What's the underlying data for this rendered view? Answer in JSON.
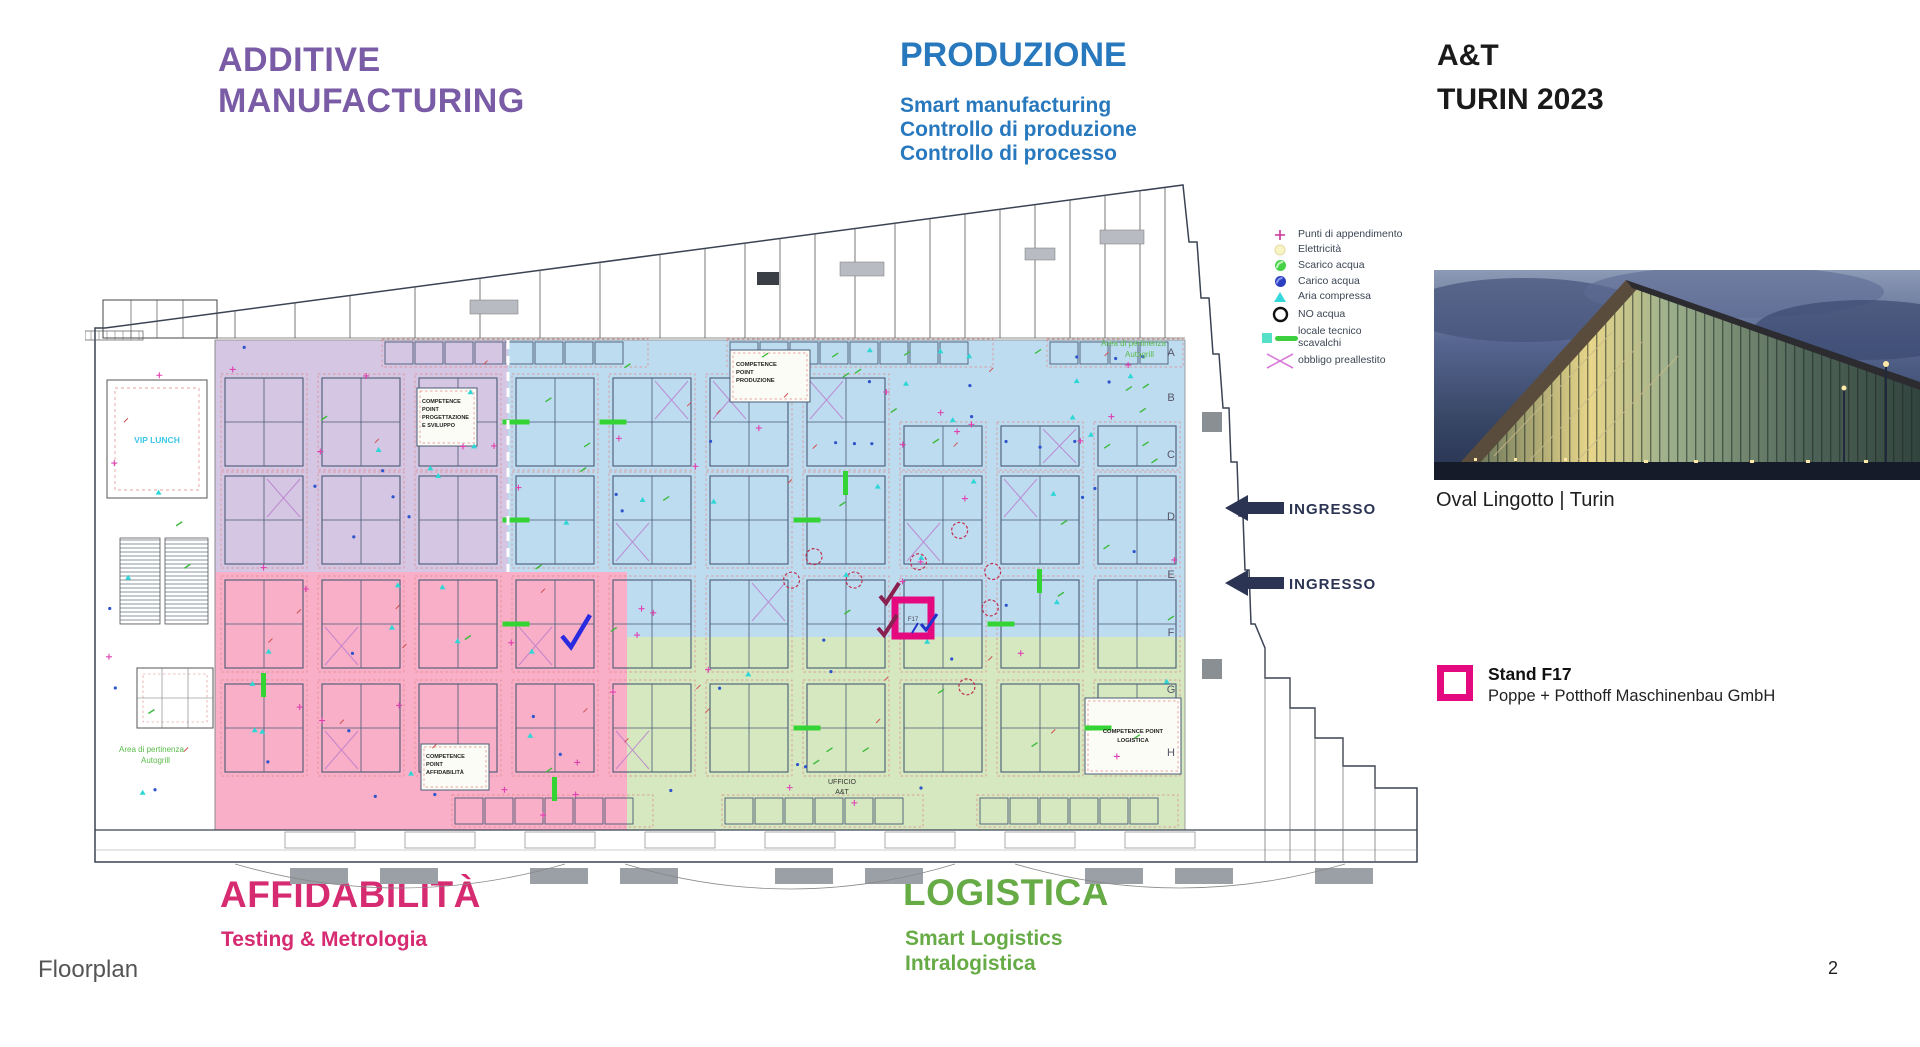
{
  "event": {
    "title_line1": "A&T",
    "title_line2": "TURIN 2023"
  },
  "sections": {
    "additive": {
      "title_line1": "ADDITIVE",
      "title_line2": "MANUFACTURING",
      "color": "#7a5ba5"
    },
    "produzione": {
      "title": "PRODUZIONE",
      "color": "#2878be",
      "subtitles": [
        "Smart manufacturing",
        "Controllo di produzione",
        "Controllo di processo"
      ]
    },
    "affidabilita": {
      "title": "AFFIDABILITÀ",
      "subtitle": "Testing & Metrologia",
      "color": "#d62a71"
    },
    "logistica": {
      "title": "LOGISTICA",
      "color": "#67ab47",
      "subtitles": [
        "Smart Logistics",
        "Intralogistica"
      ]
    }
  },
  "legend": {
    "items": [
      {
        "icon": "hang-point-icon",
        "label": "Punti di appendimento"
      },
      {
        "icon": "electricity-icon",
        "label": "Elettricità"
      },
      {
        "icon": "water-drain-icon",
        "label": "Scarico acqua"
      },
      {
        "icon": "water-supply-icon",
        "label": "Carico acqua"
      },
      {
        "icon": "compressed-air-icon",
        "label": "Aria compressa"
      },
      {
        "icon": "no-water-icon",
        "label": "NO acqua"
      },
      {
        "icon": "tech-room-icon",
        "label": "locale tecnico",
        "label2": "scavalchi"
      },
      {
        "icon": "pre-setup-icon",
        "label": "obbligo preallestito"
      }
    ]
  },
  "floorplan": {
    "ingresso_label": "INGRESSO",
    "row_letters": [
      "A",
      "B",
      "C",
      "D",
      "E",
      "F",
      "G",
      "H"
    ],
    "labels": {
      "vip_lunch": "VIP LUNCH",
      "ufficio_line1": "UFFICIO",
      "ufficio_line2": "A&T",
      "pertinenza_line1": "Area di pertinenza",
      "pertinenza_line2": "Autogrill",
      "cp_progettazione": [
        "COMPETENCE",
        "POINT",
        "PROGETTAZIONE",
        "E SVILUPPO"
      ],
      "cp_produzione": [
        "COMPETENCE",
        "POINT",
        "PRODUZIONE"
      ],
      "cp_affidabilita": [
        "COMPETENCE",
        "POINT",
        "AFFIDABILITÀ"
      ],
      "cp_logistica": [
        "COMPETENCE POINT",
        "LOGISTICA"
      ]
    },
    "stand_booth_label": "F17",
    "marker_color": "#e5097f",
    "zone_fills": {
      "additive_manufacturing": "#c9b6dd",
      "produzione": "#aed3ec",
      "affidabilita": "#f590b2",
      "logistica": "#c9e2ae"
    }
  },
  "venue": {
    "caption": "Oval Lingotto | Turin"
  },
  "stand": {
    "title": "Stand F17",
    "company": "Poppe + Potthoff Maschinenbau GmbH"
  },
  "footer": {
    "label": "Floorplan",
    "page": "2"
  }
}
